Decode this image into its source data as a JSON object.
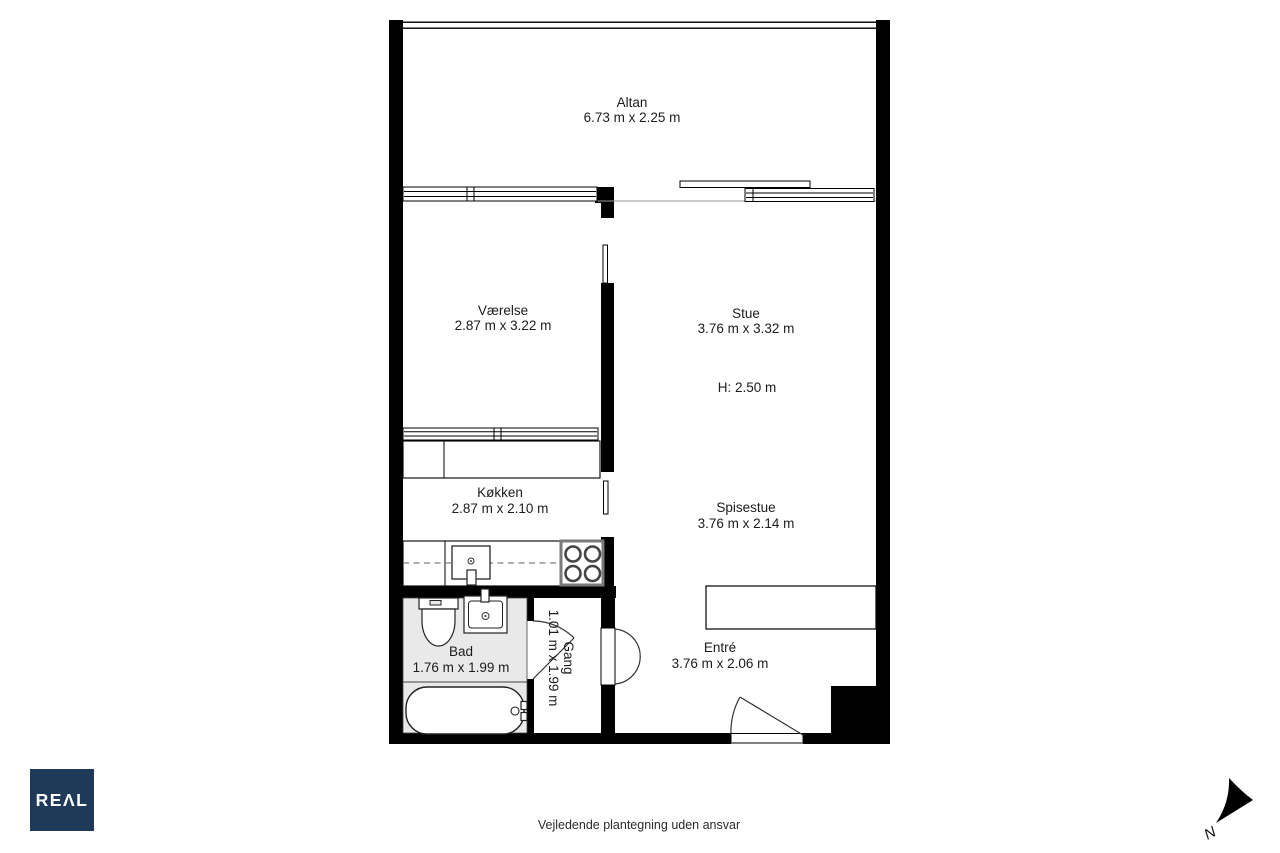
{
  "plan": {
    "rooms": [
      {
        "id": "altan",
        "name": "Altan",
        "dims": "6.73 m x 2.25 m"
      },
      {
        "id": "vaerelse",
        "name": "Værelse",
        "dims": "2.87 m x 3.22 m"
      },
      {
        "id": "stue",
        "name": "Stue",
        "dims": "3.76 m x 3.32 m",
        "ceiling_height": "H: 2.50 m"
      },
      {
        "id": "kokken",
        "name": "Køkken",
        "dims": "2.87 m x 2.10 m"
      },
      {
        "id": "spisestue",
        "name": "Spisestue",
        "dims": "3.76 m x 2.14 m"
      },
      {
        "id": "bad",
        "name": "Bad",
        "dims": "1.76 m x 1.99 m"
      },
      {
        "id": "gang",
        "name": "Gang",
        "dims": "1.01 m x 1.99 m"
      },
      {
        "id": "entre",
        "name": "Entré",
        "dims": "3.76 m x 2.06 m"
      }
    ],
    "north_label": "N"
  },
  "branding": {
    "logo_text": "REAL",
    "logo_display": "REΛL",
    "logo_bg": "#1f3a58",
    "logo_text_color": "#ffffff"
  },
  "footer": {
    "disclaimer": "Vejledende plantegning uden ansvar"
  },
  "colors": {
    "background": "#ffffff",
    "walls": "#000000",
    "bathroom_floor": "#e9e9e9",
    "label_text": "#1c1c1c"
  }
}
